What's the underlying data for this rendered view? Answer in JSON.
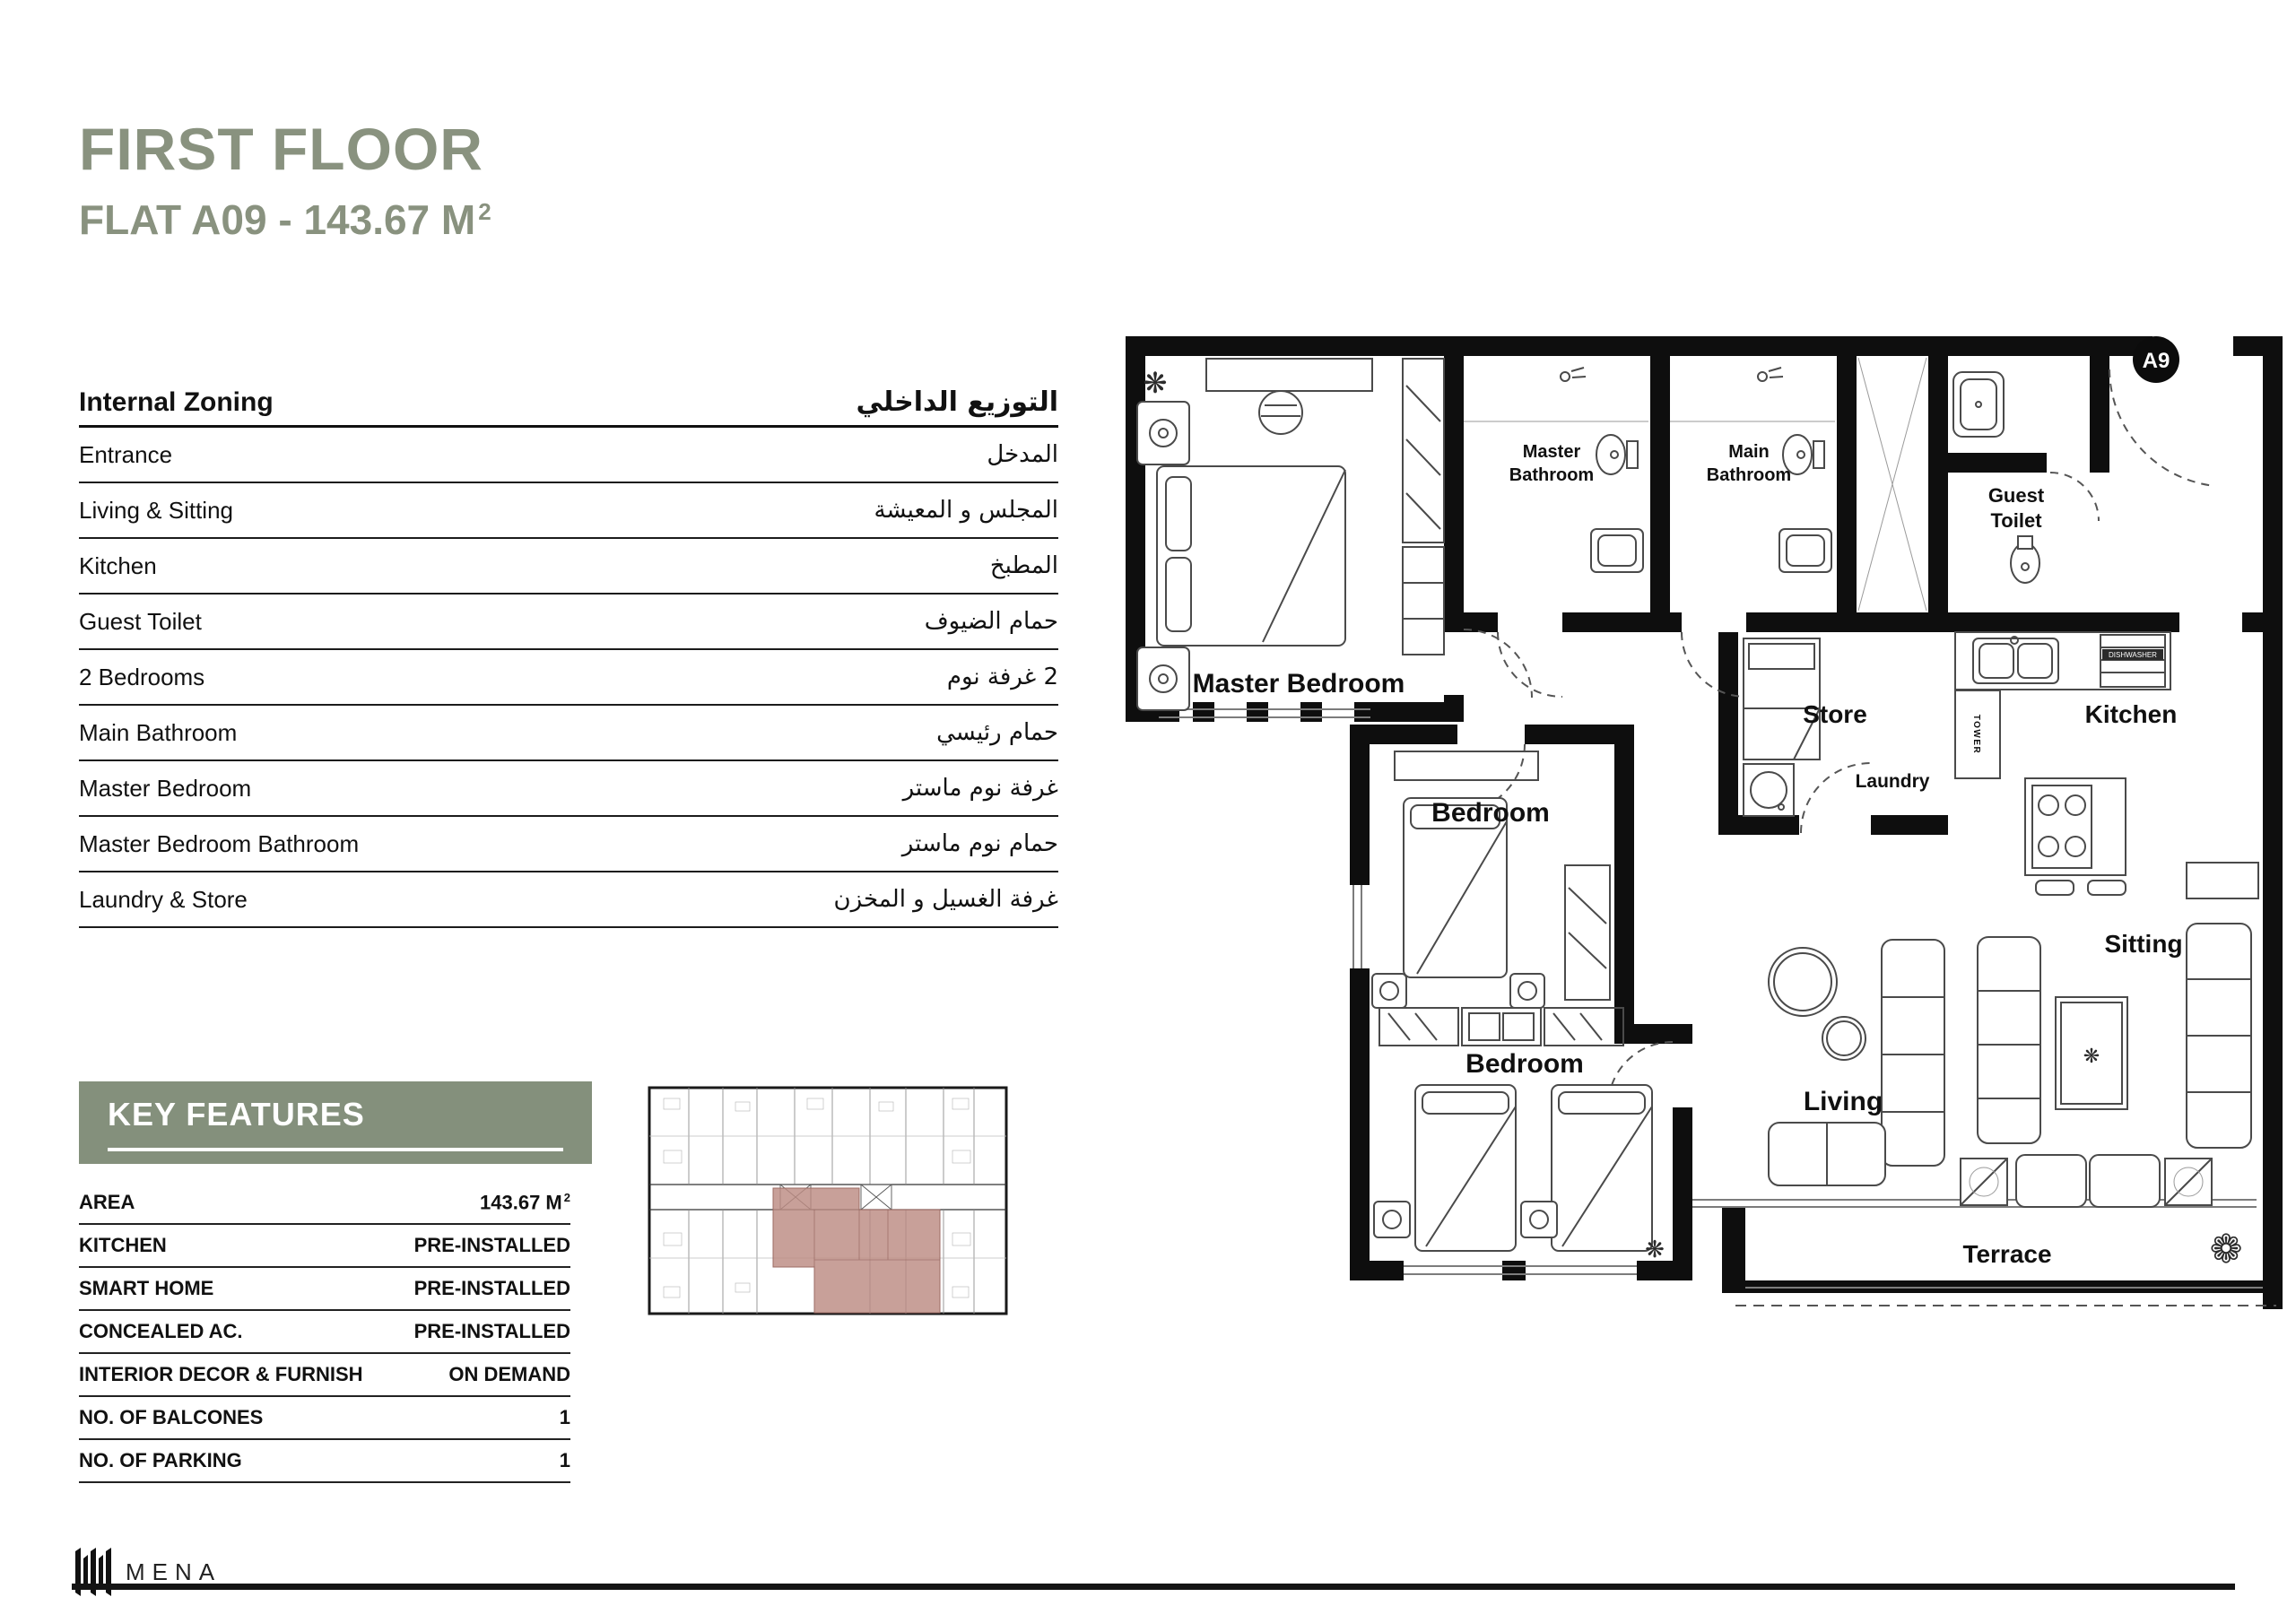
{
  "page": {
    "title": "FIRST FLOOR",
    "subtitle": "FLAT A09 - 143.67 M",
    "subtitle_sup": "2"
  },
  "zoning": {
    "header_en": "Internal Zoning",
    "header_ar": "التوزيع الداخلي",
    "rows": [
      {
        "en": "Entrance",
        "ar": "المدخل"
      },
      {
        "en": "Living & Sitting",
        "ar": "المجلس و المعيشة"
      },
      {
        "en": "Kitchen",
        "ar": "المطبخ"
      },
      {
        "en": "Guest Toilet",
        "ar": "حمام الضيوف"
      },
      {
        "en": "2 Bedrooms",
        "ar": "2 غرفة نوم"
      },
      {
        "en": "Main Bathroom",
        "ar": "حمام رئيسي"
      },
      {
        "en": "Master Bedroom",
        "ar": "غرفة نوم ماستر"
      },
      {
        "en": "Master Bedroom Bathroom",
        "ar": "حمام نوم ماستر"
      },
      {
        "en": "Laundry & Store",
        "ar": "غرفة الغسيل و المخزن"
      }
    ]
  },
  "key_features": {
    "title": "KEY FEATURES",
    "rows": [
      {
        "label": "AREA",
        "value": "143.67 M",
        "sup": "2"
      },
      {
        "label": "KITCHEN",
        "value": "PRE-INSTALLED"
      },
      {
        "label": "SMART HOME",
        "value": "PRE-INSTALLED"
      },
      {
        "label": "CONCEALED AC.",
        "value": "PRE-INSTALLED"
      },
      {
        "label": "INTERIOR DECOR & FURNISH",
        "value": "ON DEMAND"
      },
      {
        "label": "NO. OF BALCONES",
        "value": "1"
      },
      {
        "label": "NO. OF PARKING",
        "value": "1"
      }
    ]
  },
  "plan": {
    "unit_badge": "A9",
    "rooms": {
      "master_bedroom": "Master Bedroom",
      "master_bathroom_l1": "Master",
      "master_bathroom_l2": "Bathroom",
      "main_bathroom_l1": "Main",
      "main_bathroom_l2": "Bathroom",
      "guest_toilet_l1": "Guest",
      "guest_toilet_l2": "Toilet",
      "store": "Store",
      "laundry": "Laundry",
      "kitchen": "Kitchen",
      "bedroom_1": "Bedroom",
      "bedroom_2": "Bedroom",
      "living": "Living",
      "sitting": "Sitting",
      "terrace": "Terrace",
      "tower": "TOWER",
      "dishwasher": "DISHWASHER"
    }
  },
  "footer": {
    "brand": "MENA"
  },
  "colors": {
    "accent_green": "#89927F",
    "bar_green": "#84907C",
    "highlight_rose": "#BC8B83"
  }
}
